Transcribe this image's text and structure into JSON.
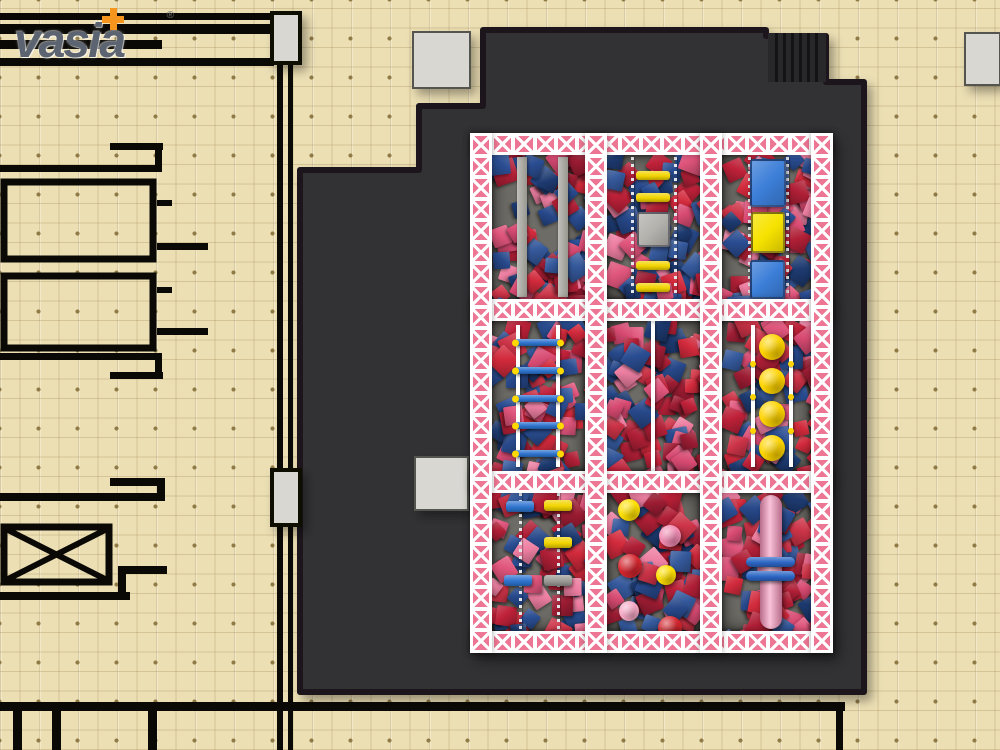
{
  "page": {
    "title": "Indoor playground foam pit - top view floor plan render"
  },
  "logo": {
    "brand": "vasia",
    "registered": "®"
  },
  "colors": {
    "bg": "#ecdfb4",
    "grid_dot": "#8f7a46",
    "plan": "#0a0905",
    "platform": "#313034",
    "platform_edge": "#1a191c",
    "stair": "#28272a",
    "stair_stripe": "#131215",
    "column": "#d8d7d2",
    "column_edge": "#55544f",
    "truss_pink": "#ec7693",
    "truss_deep": "#e05a7d",
    "pit_floor": "#6e6c66",
    "chain": "#e3e5e9",
    "rail": "#ffffff",
    "logo_text": "#5b6470",
    "logo_plus": "#f6951d"
  },
  "foam_palette": [
    "#bf2139",
    "#d22a3c",
    "#9c1c33",
    "#cc3347",
    "#b01f36",
    "#e0557c",
    "#ee7fa2",
    "#d84a72",
    "#27488a",
    "#1d3a70",
    "#35599c",
    "#2a4d92"
  ],
  "equipment": [
    {
      "t": "beam",
      "n": "balance-beam",
      "x": 47,
      "y": 24,
      "w": 10,
      "h": 140
    },
    {
      "t": "beam",
      "n": "balance-beam",
      "x": 88,
      "y": 24,
      "w": 10,
      "h": 140
    },
    {
      "t": "chain",
      "n": "chain",
      "x": 161,
      "y": 24,
      "w": 3,
      "h": 140
    },
    {
      "t": "chain",
      "n": "chain",
      "x": 204,
      "y": 24,
      "w": 3,
      "h": 140
    },
    {
      "t": "bar",
      "n": "rung-yellow",
      "x": 166,
      "y": 38,
      "w": 34,
      "h": 9,
      "c": "#f2d400"
    },
    {
      "t": "bar",
      "n": "rung-yellow",
      "x": 166,
      "y": 60,
      "w": 34,
      "h": 9,
      "c": "#f2d400"
    },
    {
      "t": "pad",
      "n": "platform-pad-gray",
      "x": 167,
      "y": 79,
      "w": 33,
      "h": 35,
      "c": "#b3b2ad"
    },
    {
      "t": "bar",
      "n": "rung-yellow",
      "x": 166,
      "y": 128,
      "w": 34,
      "h": 9,
      "c": "#f2d400"
    },
    {
      "t": "bar",
      "n": "rung-yellow",
      "x": 166,
      "y": 150,
      "w": 34,
      "h": 9,
      "c": "#f2d400"
    },
    {
      "t": "chain",
      "n": "chain",
      "x": 278,
      "y": 24,
      "w": 3,
      "h": 140
    },
    {
      "t": "chain",
      "n": "chain",
      "x": 316,
      "y": 24,
      "w": 3,
      "h": 140
    },
    {
      "t": "pad",
      "n": "climb-pad-blue",
      "x": 280,
      "y": 26,
      "w": 36,
      "h": 48,
      "c": "#3c7ed8"
    },
    {
      "t": "pad",
      "n": "climb-pad-yellow",
      "x": 281,
      "y": 79,
      "w": 34,
      "h": 41,
      "c": "#f7e300"
    },
    {
      "t": "pad",
      "n": "climb-pad-blue",
      "x": 280,
      "y": 127,
      "w": 35,
      "h": 39,
      "c": "#3c7ed8"
    },
    {
      "t": "rail",
      "n": "ladder-rail",
      "x": 46,
      "y": 192,
      "w": 4,
      "h": 142
    },
    {
      "t": "rail",
      "n": "ladder-rail",
      "x": 86,
      "y": 192,
      "w": 4,
      "h": 142
    },
    {
      "t": "bar",
      "n": "rung-blue",
      "x": 44,
      "y": 206,
      "w": 48,
      "h": 7,
      "c": "#2e74cf",
      "caps": "#ffd900"
    },
    {
      "t": "bar",
      "n": "rung-blue",
      "x": 44,
      "y": 234,
      "w": 48,
      "h": 7,
      "c": "#2e74cf",
      "caps": "#ffd900"
    },
    {
      "t": "bar",
      "n": "rung-blue",
      "x": 44,
      "y": 262,
      "w": 48,
      "h": 7,
      "c": "#2e74cf",
      "caps": "#ffd900"
    },
    {
      "t": "bar",
      "n": "rung-blue",
      "x": 44,
      "y": 289,
      "w": 48,
      "h": 7,
      "c": "#2e74cf",
      "caps": "#ffd900"
    },
    {
      "t": "bar",
      "n": "rung-blue",
      "x": 44,
      "y": 317,
      "w": 48,
      "h": 7,
      "c": "#2e74cf",
      "caps": "#ffd900"
    },
    {
      "t": "rail",
      "n": "divider-rail",
      "x": 181,
      "y": 188,
      "w": 4,
      "h": 150
    },
    {
      "t": "rail",
      "n": "disc-rail",
      "x": 281,
      "y": 192,
      "w": 4,
      "h": 142
    },
    {
      "t": "rail",
      "n": "disc-rail",
      "x": 319,
      "y": 192,
      "w": 4,
      "h": 142
    },
    {
      "t": "ball",
      "n": "stepping-disc",
      "cx": 302,
      "cy": 214,
      "d": 26,
      "c": "#ffd400"
    },
    {
      "t": "ball",
      "n": "stepping-disc",
      "cx": 302,
      "cy": 248,
      "d": 26,
      "c": "#ffd400"
    },
    {
      "t": "ball",
      "n": "stepping-disc",
      "cx": 302,
      "cy": 281,
      "d": 26,
      "c": "#ffd400"
    },
    {
      "t": "ball",
      "n": "stepping-disc",
      "cx": 302,
      "cy": 315,
      "d": 26,
      "c": "#ffd400"
    },
    {
      "t": "dot",
      "n": "rail-dot",
      "cx": 283,
      "cy": 231,
      "d": 6,
      "c": "#ffd400"
    },
    {
      "t": "dot",
      "n": "rail-dot",
      "cx": 283,
      "cy": 264,
      "d": 6,
      "c": "#ffd400"
    },
    {
      "t": "dot",
      "n": "rail-dot",
      "cx": 283,
      "cy": 298,
      "d": 6,
      "c": "#ffd400"
    },
    {
      "t": "dot",
      "n": "rail-dot",
      "cx": 321,
      "cy": 231,
      "d": 6,
      "c": "#ffd400"
    },
    {
      "t": "dot",
      "n": "rail-dot",
      "cx": 321,
      "cy": 264,
      "d": 6,
      "c": "#ffd400"
    },
    {
      "t": "dot",
      "n": "rail-dot",
      "cx": 321,
      "cy": 298,
      "d": 6,
      "c": "#ffd400"
    },
    {
      "t": "chain",
      "n": "chain",
      "x": 49,
      "y": 360,
      "w": 3,
      "h": 136
    },
    {
      "t": "chain",
      "n": "chain",
      "x": 87,
      "y": 360,
      "w": 3,
      "h": 136
    },
    {
      "t": "bar",
      "n": "ninja-bar-blue",
      "x": 36,
      "y": 368,
      "w": 28,
      "h": 11,
      "c": "#2e74cf"
    },
    {
      "t": "bar",
      "n": "ninja-bar-yellow",
      "x": 74,
      "y": 367,
      "w": 28,
      "h": 11,
      "c": "#f2d400"
    },
    {
      "t": "bar",
      "n": "ninja-bar-yellow",
      "x": 74,
      "y": 404,
      "w": 28,
      "h": 11,
      "c": "#f2d400"
    },
    {
      "t": "bar",
      "n": "ninja-bar-blue",
      "x": 34,
      "y": 442,
      "w": 28,
      "h": 11,
      "c": "#2e74cf"
    },
    {
      "t": "bar",
      "n": "ninja-bar-gray",
      "x": 74,
      "y": 442,
      "w": 28,
      "h": 11,
      "c": "#9b9a95"
    },
    {
      "t": "ball",
      "n": "foam-ball-yellow",
      "cx": 159,
      "cy": 377,
      "d": 22,
      "c": "#ffe000"
    },
    {
      "t": "ball",
      "n": "foam-ball-pink",
      "cx": 200,
      "cy": 403,
      "d": 22,
      "c": "#f08bb2"
    },
    {
      "t": "ball",
      "n": "foam-ball-red",
      "cx": 160,
      "cy": 433,
      "d": 24,
      "c": "#d3262e"
    },
    {
      "t": "ball",
      "n": "foam-ball-yellow",
      "cx": 196,
      "cy": 442,
      "d": 20,
      "c": "#ffe000"
    },
    {
      "t": "ball",
      "n": "foam-ball-pink",
      "cx": 159,
      "cy": 478,
      "d": 20,
      "c": "#f5a8c4"
    },
    {
      "t": "ball",
      "n": "foam-ball-red",
      "cx": 200,
      "cy": 495,
      "d": 24,
      "c": "#d3262e"
    },
    {
      "t": "pole",
      "n": "slide-pole",
      "x": 290,
      "y": 362,
      "w": 22,
      "h": 134,
      "c": "#f590b8"
    },
    {
      "t": "bar",
      "n": "pole-ring-blue",
      "x": 276,
      "y": 424,
      "w": 49,
      "h": 10,
      "c": "#2c66c4",
      "r": 5
    },
    {
      "t": "bar",
      "n": "pole-ring-blue",
      "x": 276,
      "y": 438,
      "w": 49,
      "h": 10,
      "c": "#2c66c4",
      "r": 5
    }
  ]
}
